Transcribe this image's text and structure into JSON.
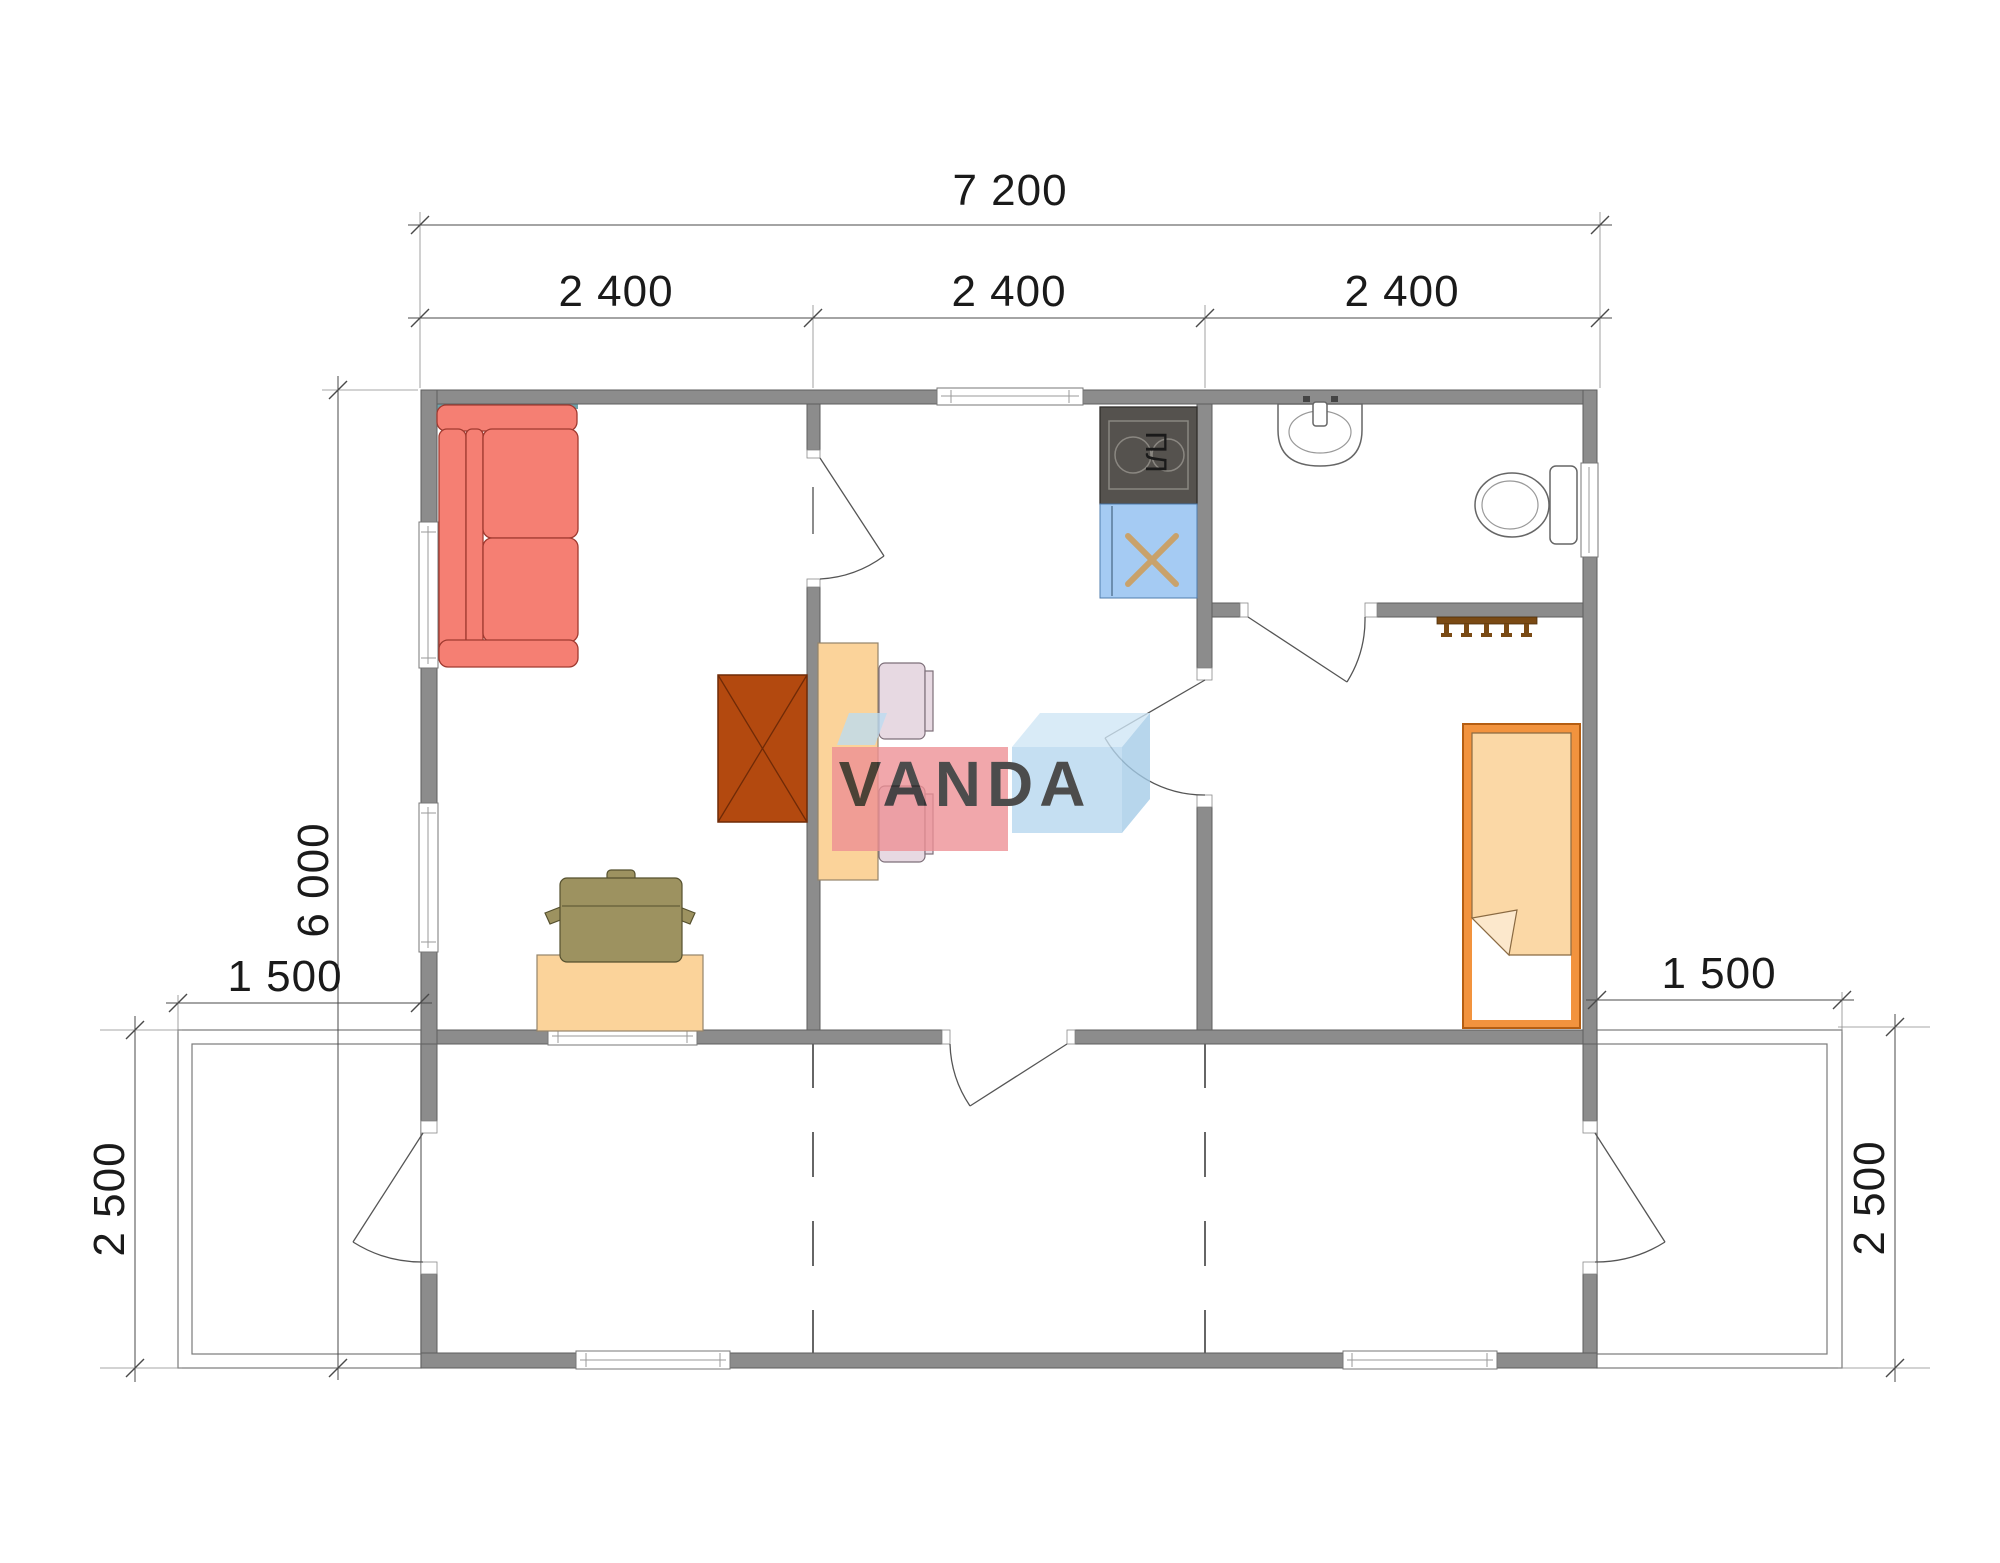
{
  "brand": {
    "watermark_text": "VANDA"
  },
  "dimensions": {
    "overall_width": "7 200",
    "module_widths": [
      "2 400",
      "2 400",
      "2 400"
    ],
    "overall_depth": "6 000",
    "terrace_side_left": "1 500",
    "terrace_side_right": "1 500",
    "terrace_depth_left": "2 500",
    "terrace_depth_right": "2 500"
  },
  "labels": {
    "stove_label": "ПЛ"
  },
  "colors": {
    "wall_gray": "#8C8C8C",
    "sofa_red": "#F57F73",
    "coffee_table_brown": "#B3490F",
    "table_peach": "#FBD39A",
    "chair_pink": "#E7D9E2",
    "office_chair_olive": "#9D9260",
    "bed_orange": "#F2933E",
    "blanket_peach": "#FBD8A6",
    "stove_dark": "#55524E",
    "sink_blue": "#A5CBF3",
    "accent_teal": "#6FA0A8",
    "logo_red": "#EE8F94",
    "logo_blue": "#B5D7EF",
    "hanger_brown": "#7A4A14"
  }
}
